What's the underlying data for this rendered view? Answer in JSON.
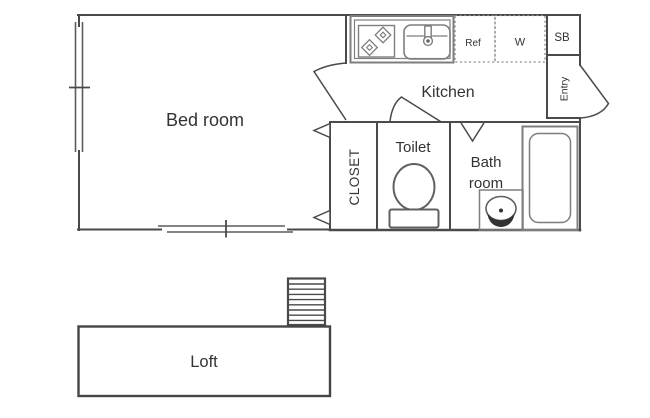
{
  "floorplan": {
    "rooms": {
      "bedroom": {
        "label": "Bed room"
      },
      "kitchen": {
        "label": "Kitchen"
      },
      "closet": {
        "label": "CLOSET"
      },
      "toilet": {
        "label": "Toilet"
      },
      "bathroom": {
        "label": "Bath room",
        "line1": "Bath",
        "line2": "room"
      },
      "entry": {
        "label": "Entry"
      },
      "loft": {
        "label": "Loft"
      }
    },
    "appliance_spaces": {
      "refrigerator": {
        "label": "Ref"
      },
      "washer": {
        "label": "W"
      },
      "shoe_box": {
        "label": "SB"
      }
    },
    "icons": [
      "stove-icon",
      "sink-icon",
      "faucet-icon",
      "toilet-icon",
      "bathtub-icon",
      "washbasin-icon",
      "ladder-icon",
      "window-icon",
      "door-swing-icon",
      "folding-door-icon"
    ],
    "colors": {
      "wall": "#4a4a4a",
      "fixture": "#7e7e7e",
      "text": "#333333",
      "background": "#ffffff"
    }
  }
}
